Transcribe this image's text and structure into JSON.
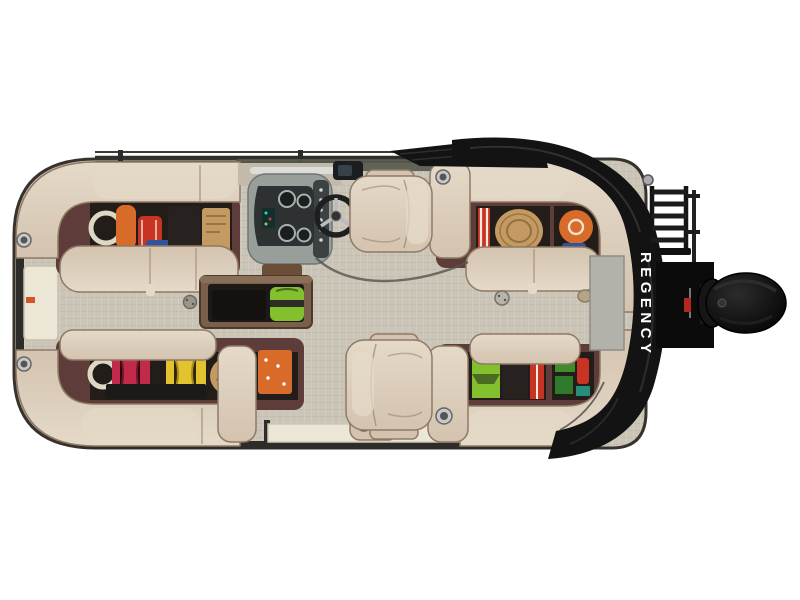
{
  "scene": {
    "type": "product-photo",
    "subject": "pontoon boat, top-down overhead view",
    "description": "Studio photo of a REGENCY pontoon boat seen from directly above on a white background: tan wrap-around lounges with lifted seats revealing storage full of gear, helm console with steering wheel, captain and companion chairs, in-floor ski locker with a green bag, folded black bimini cover with brand lettering wrapping the stern, boarding ladder and black outboard motor.",
    "background": "#ffffff",
    "view": "top-down"
  },
  "brand": {
    "name": "REGENCY",
    "orientation": "vertical-top-to-bottom",
    "location": "stern cover"
  },
  "palette": {
    "background": "#ffffff",
    "hull": "#37322c",
    "floor": "#cbc5b8",
    "floor_weave": "#bfb9ab",
    "floor_light": "#d7d1c4",
    "seat": "#d3c3af",
    "seat_hi": "#e5d9c8",
    "seat_sh": "#a98f79",
    "seat_edge": "#8f7a66",
    "trim_maroon": "#5d3c3a",
    "storage_dark": "#221d19",
    "console": "#989e9a",
    "console_dark": "#2d3132",
    "console_mid": "#6e7573",
    "cover": "#131313",
    "cover_hi": "#343434",
    "motor": "#0b0b0b",
    "motor_hi": "#2c2c2c",
    "rail": "#2e2c28",
    "gate": "#ebe6d5",
    "metal": "#b9b4a9",
    "olive_trim": "#57584c",
    "wood": "#6b4e37",
    "gear_orange": "#d96b2a",
    "gear_red": "#c93323",
    "gear_crimson": "#c22a49",
    "gear_blue": "#30549c",
    "gear_yellow": "#e2c32f",
    "gear_green": "#82c02e",
    "gear_dark_green": "#3f8c2a",
    "gear_tan": "#c49a62",
    "gear_cream": "#ded7c4",
    "gear_black": "#27221f",
    "brand_text": "#ffffff"
  },
  "parts": {
    "lounge_top_left": "L-shaped bow lounge, seat lifted, storage with life vests, rope and bags",
    "lounge_top_right": "L-shaped stern lounge, storage with rope coils and striped fabric",
    "lounge_bottom_left": "L-shaped bow lounge, storage with red, yellow, tan and orange gear",
    "lounge_bottom_right": "L-shaped stern lounge, storage with green, black, red camping gear",
    "helm_console": "Gray fiberglass helm with gauges, switch panel and steering wheel",
    "captain_chair": "Tan captain chair at helm",
    "companion_chair": "Tan companion chair with cup-holder console",
    "floor_storage": "Open in-floor ski locker with bright green bag",
    "stern_cover": "Folded black bimini/mooring cover with REGENCY lettering",
    "outboard_motor": "Black outboard motor on stern bracket",
    "boarding_ladder": "Folded boarding ladder at stern",
    "bow_gate": "Cream bow boarding gate",
    "side_gate": "Cream side gate on lower deck edge"
  }
}
